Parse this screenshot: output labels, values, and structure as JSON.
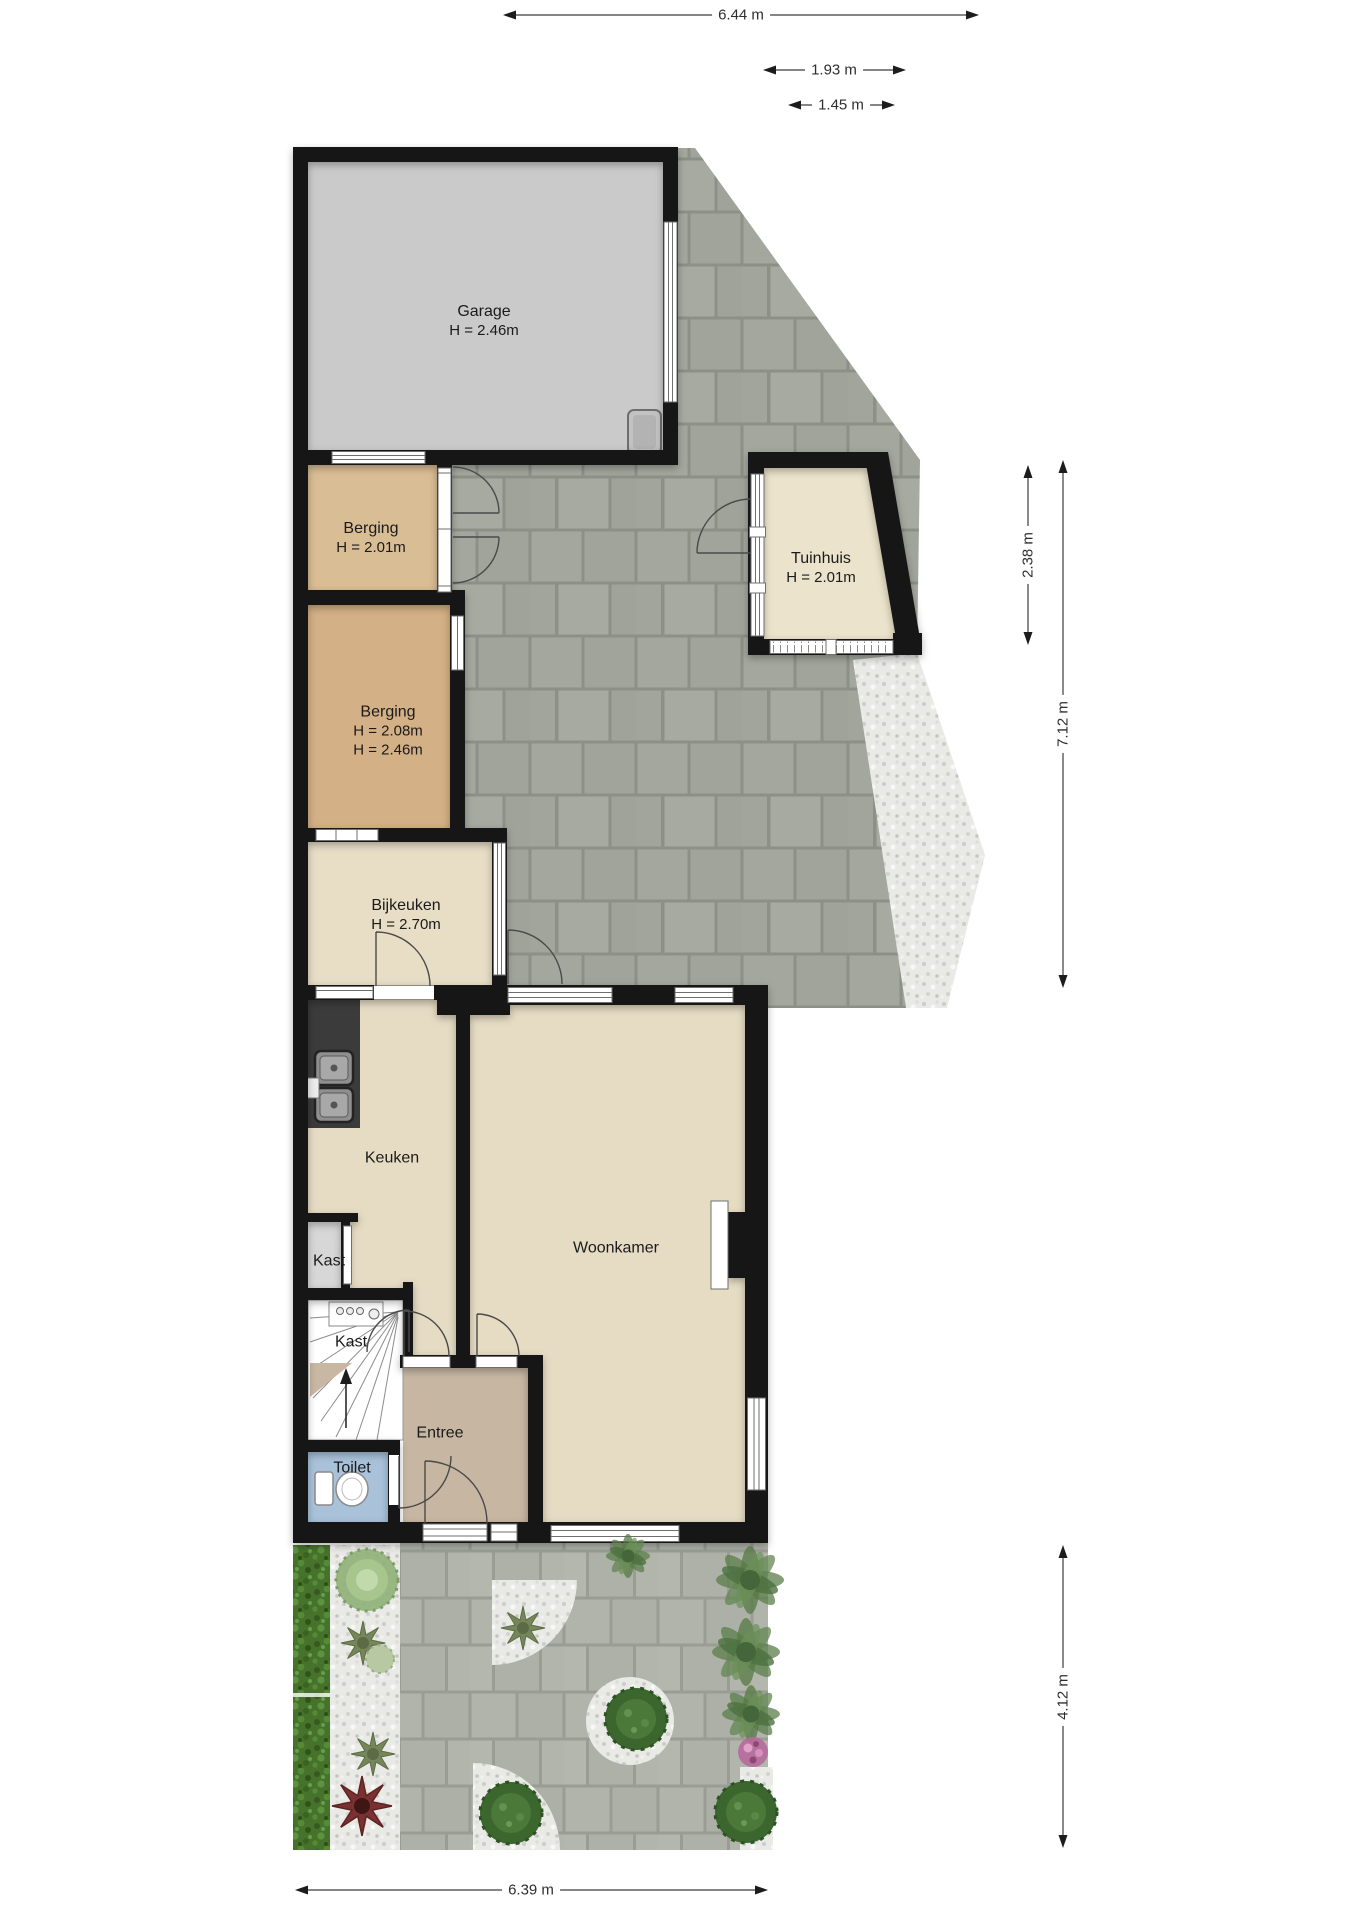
{
  "rooms": {
    "garage": {
      "name": "Garage",
      "h1": "H = 2.46m"
    },
    "berging1": {
      "name": "Berging",
      "h1": "H = 2.01m"
    },
    "berging2": {
      "name": "Berging",
      "h1": "H = 2.08m",
      "h2": "H = 2.46m"
    },
    "tuinhuis": {
      "name": "Tuinhuis",
      "h1": "H = 2.01m"
    },
    "bijkeuken": {
      "name": "Bijkeuken",
      "h1": "H = 2.70m"
    },
    "keuken": {
      "name": "Keuken"
    },
    "woonkamer": {
      "name": "Woonkamer"
    },
    "kast_boven": {
      "name": "Kast"
    },
    "kast_trap": {
      "name": "Kast"
    },
    "entree": {
      "name": "Entree"
    },
    "toilet": {
      "name": "Toilet"
    }
  },
  "dimensions": {
    "top_total": "6.44 m",
    "tuinhuis_breedte": "1.93 m",
    "tuinhuis_smal": "1.45 m",
    "tuinhuis_diepte": "2.38 m",
    "achtererf_diepte": "7.12 m",
    "voortuin_diepte": "4.12 m",
    "onder_breedte": "6.39 m"
  },
  "colors": {
    "wall": "#141414",
    "garage_floor": "#cacaca",
    "berging1_floor": "#d9bd94",
    "berging2_floor": "#d3b085",
    "woon_floor": "#e6dcc4",
    "tuinhuis_floor": "#ebe3cb",
    "entree_floor": "#c6b6a2",
    "toilet_floor": "#a9c2da",
    "kast_floor": "#d7d7d7",
    "terras_tegel": "#a4a79e",
    "tuin_tegel": "#b1b4ab",
    "heg": "#47722c",
    "grind": "#e9e9e6"
  }
}
